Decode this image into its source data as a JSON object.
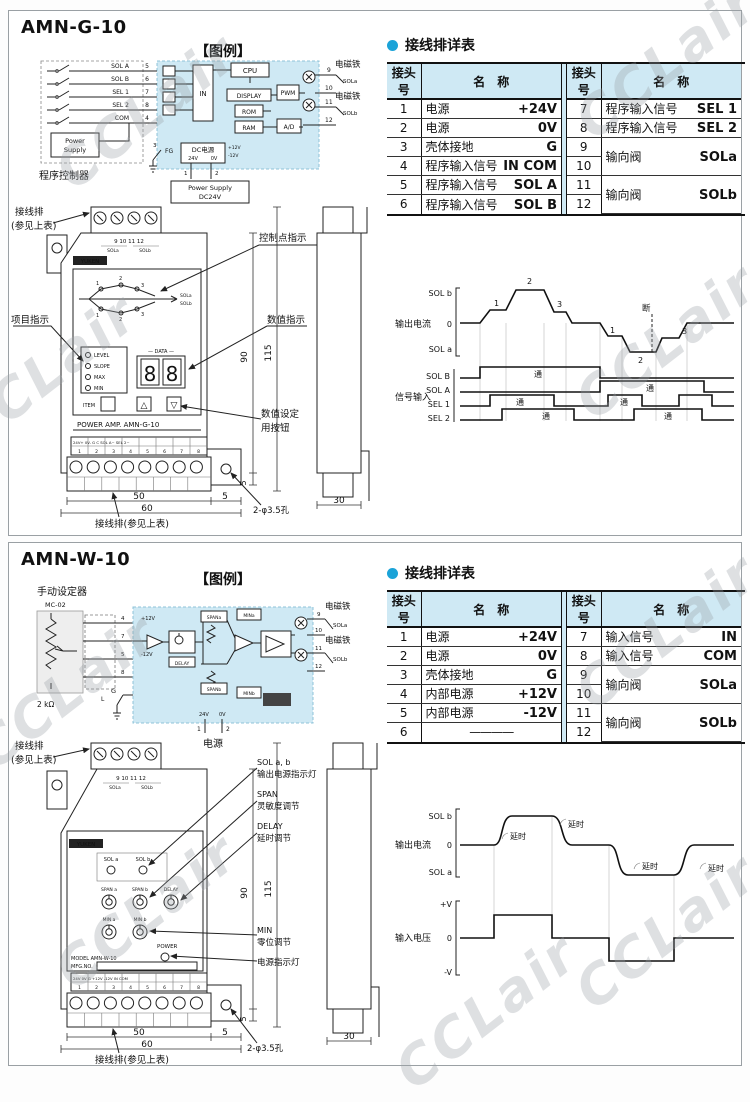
{
  "watermark": {
    "text": "CCLair"
  },
  "g10": {
    "title": "AMN-G-10",
    "legend": "【图例】",
    "circuit": {
      "controller": "程序控制器",
      "ps_l1": "Power",
      "ps_l2": "Supply",
      "ps24_l1": "Power Supply",
      "ps24_l2": "DC24V",
      "fg": "FG",
      "pin3": "3",
      "pin1": "1",
      "pin2": "2",
      "cpu": "CPU",
      "in": "IN",
      "display": "DISPLAY",
      "rom": "ROM",
      "ram": "RAM",
      "pwm": "PWM",
      "ad": "A/D",
      "dc": "DC电源",
      "v24": "24V",
      "v0": "0V",
      "p12": "+12V",
      "m12": "-12V",
      "in1": "SOL A",
      "in1p": "5",
      "in2": "SOL B",
      "in2p": "6",
      "in3": "SEL 1",
      "in3p": "7",
      "in4": "SEL 2",
      "in4p": "8",
      "in5": "COM",
      "in5p": "4",
      "o9": "9",
      "o10": "10",
      "o11": "11",
      "o12": "12",
      "mag": "电磁铁",
      "sola": "SOLa",
      "solb": "SOLb"
    },
    "table": {
      "title": "接线排详表",
      "h_no": "接头号",
      "h_name": "名　称",
      "l": [
        [
          "1",
          "电源",
          "+24V"
        ],
        [
          "2",
          "电源",
          "0V"
        ],
        [
          "3",
          "壳体接地",
          "G"
        ],
        [
          "4",
          "程序输入信号",
          "IN COM"
        ],
        [
          "5",
          "程序输入信号",
          "SOL A"
        ],
        [
          "6",
          "程序输入信号",
          "SOL B"
        ]
      ],
      "r7": [
        "7",
        "程序输入信号",
        "SEL 1"
      ],
      "r8": [
        "8",
        "程序输入信号",
        "SEL 2"
      ],
      "m1": {
        "a": "9",
        "b": "10",
        "name": "输向阀",
        "val": "SOLa"
      },
      "m2": {
        "a": "11",
        "b": "12",
        "name": "输向阀",
        "val": "SOLb"
      }
    },
    "front": {
      "cl_top1": "接线排",
      "cl_top2": "(参见上表)",
      "cl_item": "项目指示",
      "cl_ctrl": "控制点指示",
      "cl_val": "数值指示",
      "cl_set1": "数值设定",
      "cl_set2": "用按钮",
      "tnums": "9  10  11  12",
      "tsola": "SOLa",
      "tsolb": "SOLb",
      "logo": "YUKEN",
      "c1": "1",
      "c2": "2",
      "c3": "3",
      "csola": "SOLa",
      "csolb": "SOLb",
      "led1": "LEVEL",
      "led2": "SLOPE",
      "led3": "MAX",
      "led4": "MIN",
      "data": "— DATA —",
      "d1": "8",
      "d2": "8",
      "item": "ITEM",
      "up": "△",
      "down": "▽",
      "caption": "POWER AMP.   AMN-G-10",
      "strip": "24V+ 0V- G  C  SOL A~  SEL 2~",
      "bnums": [
        "1",
        "2",
        "3",
        "4",
        "5",
        "6",
        "7",
        "8"
      ],
      "d90": "90",
      "d115": "115",
      "d5r": "5",
      "d50": "50",
      "d5b": "5",
      "d60": "60",
      "d30": "30",
      "hole": "2-φ3.5孔",
      "cl_bottom": "接线排(参见上表)"
    },
    "timing": {
      "solb": "SOL b",
      "zero": "0",
      "sola": "SOL a",
      "out": "输出电流",
      "sig": "信号输入",
      "rb": "SOL B",
      "ra": "SOL A",
      "r1": "SEL 1",
      "r2": "SEL 2",
      "p1": "1",
      "p2": "2",
      "p3": "3",
      "n1": "1",
      "n2": "2",
      "n3": "3",
      "duan": "断",
      "tong": "通"
    }
  },
  "w10": {
    "title": "AMN-W-10",
    "legend": "【图例】",
    "circuit": {
      "setter": "手动设定器",
      "mc": "MC-02",
      "kohm": "2 kΩ",
      "p4": "4",
      "p7": "7",
      "p5": "5",
      "p8": "8",
      "p12": "+12V",
      "m12": "-12V",
      "spana": "SPANa",
      "spanb": "SPANb",
      "delay": "DELAY",
      "mina": "MINa",
      "minb": "MINb",
      "o9": "9",
      "o10": "10",
      "o11": "11",
      "o12": "12",
      "mag": "电磁铁",
      "sola": "SOLa",
      "solb": "SOLb",
      "v24": "24V",
      "v0": "0V",
      "pin1": "1",
      "pin2": "2",
      "power": "电源",
      "g": "G",
      "l": "L"
    },
    "table": {
      "title": "接线排详表",
      "h_no": "接头号",
      "h_name": "名　称",
      "l": [
        [
          "1",
          "电源",
          "+24V"
        ],
        [
          "2",
          "电源",
          "0V"
        ],
        [
          "3",
          "壳体接地",
          "G"
        ],
        [
          "4",
          "内部电源",
          "+12V"
        ],
        [
          "5",
          "内部电源",
          "-12V"
        ],
        [
          "6",
          "————",
          ""
        ]
      ],
      "r7": [
        "7",
        "输入信号",
        "IN"
      ],
      "r8": [
        "8",
        "输入信号",
        "COM"
      ],
      "m1": {
        "a": "9",
        "b": "10",
        "name": "输向阀",
        "val": "SOLa"
      },
      "m2": {
        "a": "11",
        "b": "12",
        "name": "输向阀",
        "val": "SOLb"
      }
    },
    "front": {
      "cl_top1": "接线排",
      "cl_top2": "(参见上表)",
      "cl_sol1": "SOL a, b",
      "cl_sol2": "输出电源指示灯",
      "cl_span1": "SPAN",
      "cl_span2": "灵敏度调节",
      "cl_delay1": "DELAY",
      "cl_delay2": "延时调节",
      "cl_min1": "MIN",
      "cl_min2": "零位调节",
      "cl_power": "电源指示灯",
      "tnums": "9  10  11  12",
      "tsola": "SOLa",
      "tsolb": "SOLb",
      "logo": "YUKEN",
      "sola": "SOL a",
      "solb": "SOL b",
      "spana": "SPAN a",
      "spanb": "SPAN b",
      "delay": "DELAY",
      "mina": "MIN a",
      "minb": "MIN b",
      "power": "POWER",
      "model": "MODEL   AMN-W-10",
      "mfg": "MFG.NO.",
      "strip": "24V 0V G +12V -12V  IN COM",
      "bnums": [
        "1",
        "2",
        "3",
        "4",
        "5",
        "6",
        "7",
        "8"
      ],
      "d90": "90",
      "d115": "115",
      "d5r": "5",
      "d50": "50",
      "d5b": "5",
      "d60": "60",
      "d30": "30",
      "hole": "2-φ3.5孔",
      "cl_bottom": "接线排(参见上表)"
    },
    "timing": {
      "solb": "SOL b",
      "zero": "0",
      "sola": "SOL a",
      "out": "输出电流",
      "pv": "+V",
      "zero2": "0",
      "mv": "-V",
      "inlab": "输入电压",
      "delay": "延时"
    }
  }
}
